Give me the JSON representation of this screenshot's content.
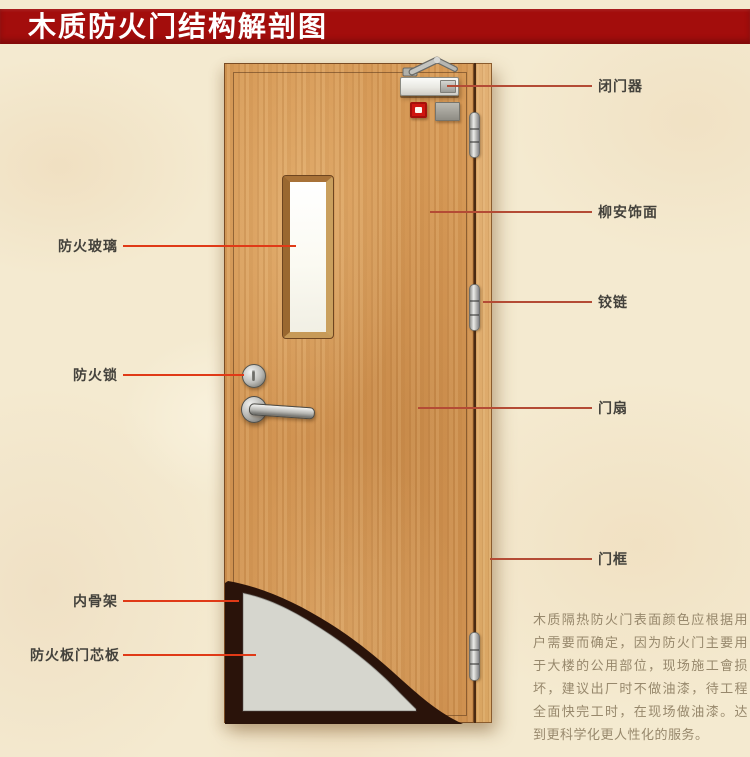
{
  "title": "木质防火门结构解剖图",
  "colors": {
    "background": "#f4ead0",
    "banner": "#a30d0c",
    "left_line": "#e03a17",
    "right_line": "#b44b35",
    "wood": "#d79a57",
    "frame_wood": "#e2b074",
    "core_gray": "#d6d6ce",
    "skeleton_dark": "#2a130a",
    "alarm_red": "#cf1510",
    "label_text": "#44423c",
    "desc_text": "#97886c"
  },
  "annotations": {
    "left": [
      {
        "label": "防火玻璃"
      },
      {
        "label": "防火锁"
      },
      {
        "label": "内骨架"
      },
      {
        "label": "防火板门芯板"
      }
    ],
    "right": [
      {
        "label": "闭门器"
      },
      {
        "label": "柳安饰面"
      },
      {
        "label": "铰链"
      },
      {
        "label": "门扇"
      },
      {
        "label": "门框"
      }
    ]
  },
  "description": {
    "text": "木质隔热防火门表面颜色应根据用户需要而确定，因为防火门主要用于大楼的公用部位，现场施工會损坏，建议出厂时不做油漆，待工程全面快完工时，在现场做油漆。达到更科学化更人性化的服务。"
  }
}
